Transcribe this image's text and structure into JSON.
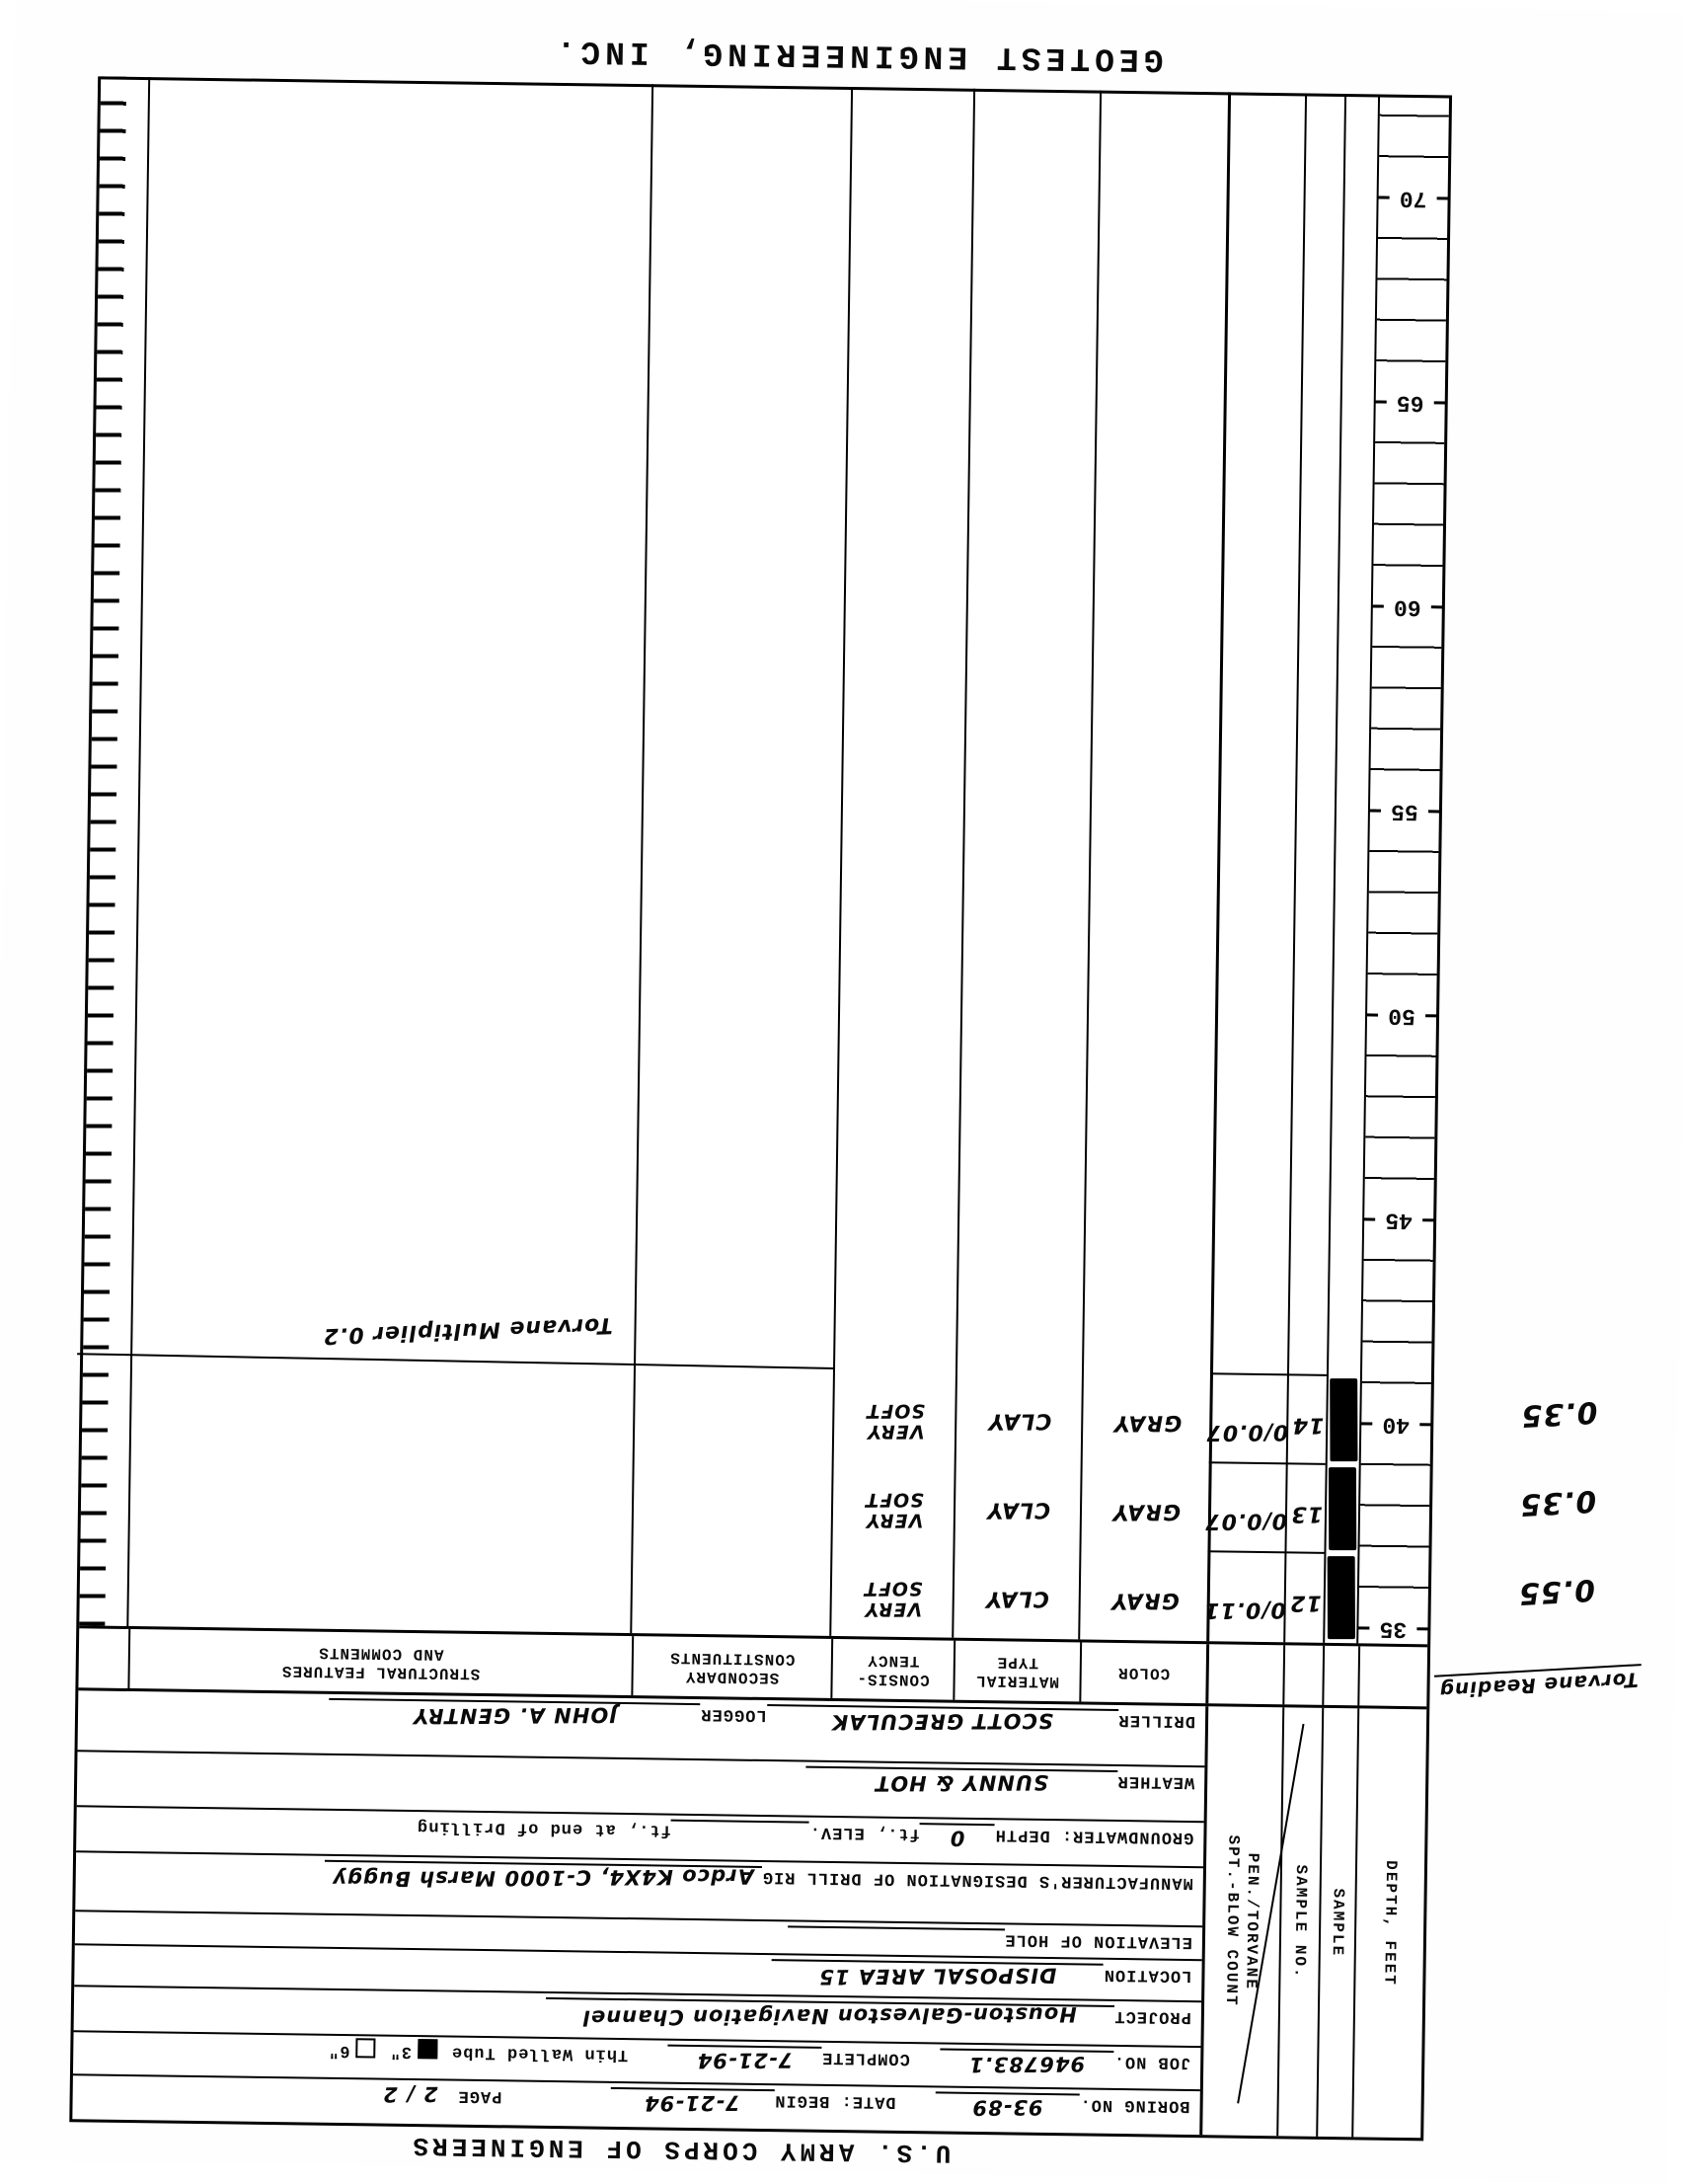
{
  "page": {
    "top_title": "U.S. ARMY CORPS OF ENGINEERS",
    "bottom_title": "GEOTEST ENGINEERING, INC."
  },
  "form": {
    "boring_no_label": "BORING NO.",
    "boring_no": "93-89",
    "date_begin_label": "DATE: BEGIN",
    "date_begin": "7-21-94",
    "page_label": "PAGE",
    "page_value": "2 / 2",
    "job_no_label": "JOB NO.",
    "job_no": "946783.1",
    "complete_label": "COMPLETE",
    "complete_date": "7-21-94",
    "tube_label": "Thin Walled Tube",
    "tube_3_label": "3\"",
    "tube_6_label": "6\"",
    "project_label": "PROJECT",
    "project": "Houston-Galveston Navigation Channel",
    "location_label": "LOCATION",
    "location": "DISPOSAL AREA 15",
    "elevation_label": "ELEVATION OF HOLE",
    "rig_label": "MANUFACTURER'S DESIGNATION OF DRILL RIG",
    "rig": "Ardco K4X4, C-1000 Marsh Buggy",
    "groundwater_label": "GROUNDWATER: DEPTH",
    "groundwater_depth": "0",
    "gw_mid_label": "ft., ELEV.",
    "gw_end_label": "ft., at end of Drilling",
    "weather_label": "WEATHER",
    "weather": "SUNNY & HOT",
    "driller_label": "DRILLER",
    "driller": "SCOTT GRECULAK",
    "logger_label": "LOGGER",
    "logger": "JOHN A. GENTRY"
  },
  "columns": {
    "depth": "DEPTH, FEET",
    "sample": "SAMPLE",
    "sample_no": "SAMPLE NO.",
    "pen_line1": "PEN./TORVANE",
    "pen_line2": "SPT.-BLOW COUNT",
    "color": "COLOR",
    "material_1": "MATERIAL",
    "material_2": "TYPE",
    "consistency_1": "CONSIS-",
    "consistency_2": "TENCY",
    "secondary_1": "SECONDARY",
    "secondary_2": "CONSTITUENTS",
    "structural_1": "STRUCTURAL FEATURES",
    "structural_2": "AND COMMENTS"
  },
  "log": {
    "depth_labels": [
      "35",
      "40",
      "45",
      "50",
      "55",
      "60",
      "65",
      "70"
    ],
    "rows": [
      {
        "sample_no": "12",
        "pen": "0/0.11",
        "color": "GRAY",
        "material": "CLAY",
        "consistency": "VERY SOFT",
        "torvane": "0.55"
      },
      {
        "sample_no": "13",
        "pen": "0/0.07",
        "color": "GRAY",
        "material": "CLAY",
        "consistency": "VERY SOFT",
        "torvane": "0.35"
      },
      {
        "sample_no": "14",
        "pen": "0/0.07",
        "color": "GRAY",
        "material": "CLAY",
        "consistency": "VERY SOFT",
        "torvane": "0.35"
      }
    ],
    "torvane_reading_label": "Torvane Reading",
    "torvane_multiplier_note": "Torvane Multiplier 0.2"
  }
}
